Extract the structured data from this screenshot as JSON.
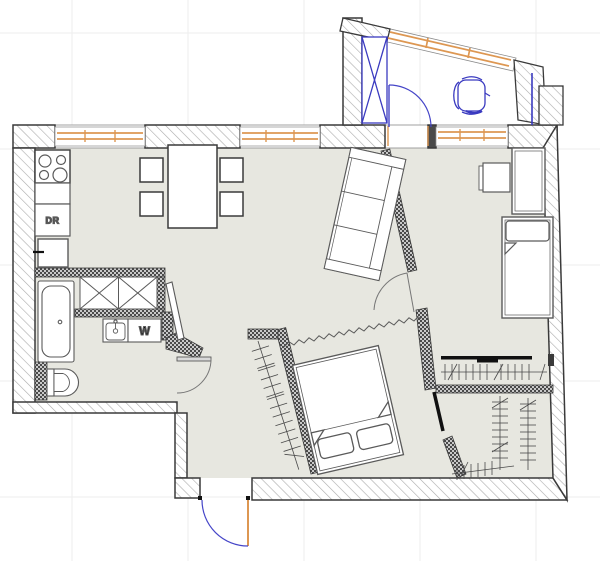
{
  "page": {
    "type": "apartment-floor-plan",
    "canvas": {
      "width": 600,
      "height": 561
    }
  },
  "labels": {
    "dryer_unit": "DR",
    "washing_machine": "W"
  },
  "colors": {
    "background": "#ffffff",
    "floor": "#e7e7e0",
    "wall_outline": "#3a3a3a",
    "wall_hatch": "#ababab",
    "partition_stipple_dark": "#4a4a4a",
    "partition_stipple_light": "#c9c9c9",
    "window_orange": "#dd9752",
    "door_blue": "#4545c8",
    "furniture_outline": "#5a5a5a",
    "door_arc_gray": "#777777",
    "rail_black": "#111111",
    "grid": "#ededed"
  },
  "symbols": [
    "stove",
    "kitchen-counter",
    "dryer-unit",
    "fridge",
    "dining-table",
    "dining-chairs",
    "hall-wardrobe",
    "bathtub",
    "toilet",
    "sink",
    "washing-machine",
    "mirror-panel",
    "sofa",
    "double-bed",
    "curtain",
    "coat-rack",
    "single-bed",
    "tall-cabinet",
    "nightstand",
    "balcony-cabinet",
    "balcony-door",
    "office-chair",
    "desk",
    "closet-rail",
    "hanger-racks",
    "entrance-door",
    "bathroom-door",
    "room-door",
    "windows"
  ]
}
